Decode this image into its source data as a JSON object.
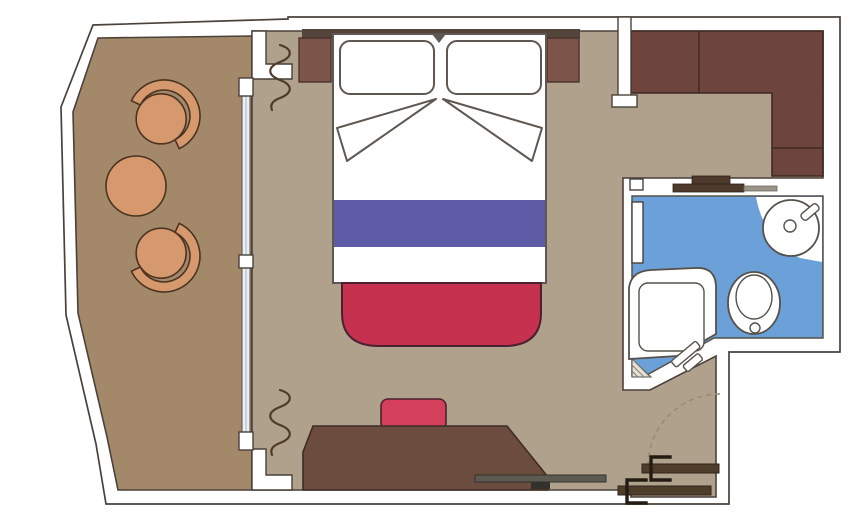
{
  "plan": {
    "kind": "cruise-cabin-floor-plan",
    "rooms": [
      {
        "id": "balcony",
        "items": [
          "armchair",
          "round-table",
          "armchair"
        ]
      },
      {
        "id": "bedroom",
        "items": [
          "double-bed",
          "pillow",
          "pillow",
          "folded-blanket",
          "bed-runner",
          "headboard",
          "nightstand",
          "nightstand",
          "foot-bench",
          "desk",
          "desk-chair",
          "wardrobe",
          "curtains",
          "sliding-glass-door"
        ]
      },
      {
        "id": "sitting-area",
        "items": [
          "corner-sofa"
        ]
      },
      {
        "id": "bathroom",
        "items": [
          "shower-tub",
          "toilet",
          "washbasin",
          "faucet",
          "shelf",
          "bathroom-door"
        ]
      },
      {
        "id": "entrance",
        "items": [
          "entry-door-panel",
          "entry-door-panel",
          "door-swing-arc"
        ]
      }
    ],
    "colors": {
      "wall_outline": "#49413a",
      "balcony_floor": "#a4886a",
      "cabin_floor": "#b0a18c",
      "bathroom_floor": "#6ba1d8",
      "furniture_tan": "#d6996e",
      "furniture_tan_outline": "#4c3421",
      "sofa_brown": "#6d453d",
      "sofa_outline": "#3f2923",
      "bed_outline": "#5f5751",
      "runner_purple": "#5d5ba6",
      "bench_red": "#c63150",
      "chair_red": "#d4405b",
      "red_outline": "#4b2130",
      "desk_brown": "#6b4c3e",
      "desk_outline": "#3e2c25",
      "headboard_brown": "#53443c",
      "nightstand_brown": "#7d544a",
      "shelf_dark": "#4e3a2c",
      "shelf_gray": "#9a9488",
      "wardrobe_gray": "#5d5a52",
      "handle_dark": "#33312c",
      "door_bar_brown": "#4f3d2b",
      "door_hook_black": "#241c13",
      "fixture_outline": "#56504a",
      "glass_blue": "#e9eff5",
      "curtain_brown": "#4f3a28",
      "swing_dash": "#9b8a74",
      "hatch_gray": "#8a8478",
      "hatch_bg": "#e6e1d7"
    }
  }
}
